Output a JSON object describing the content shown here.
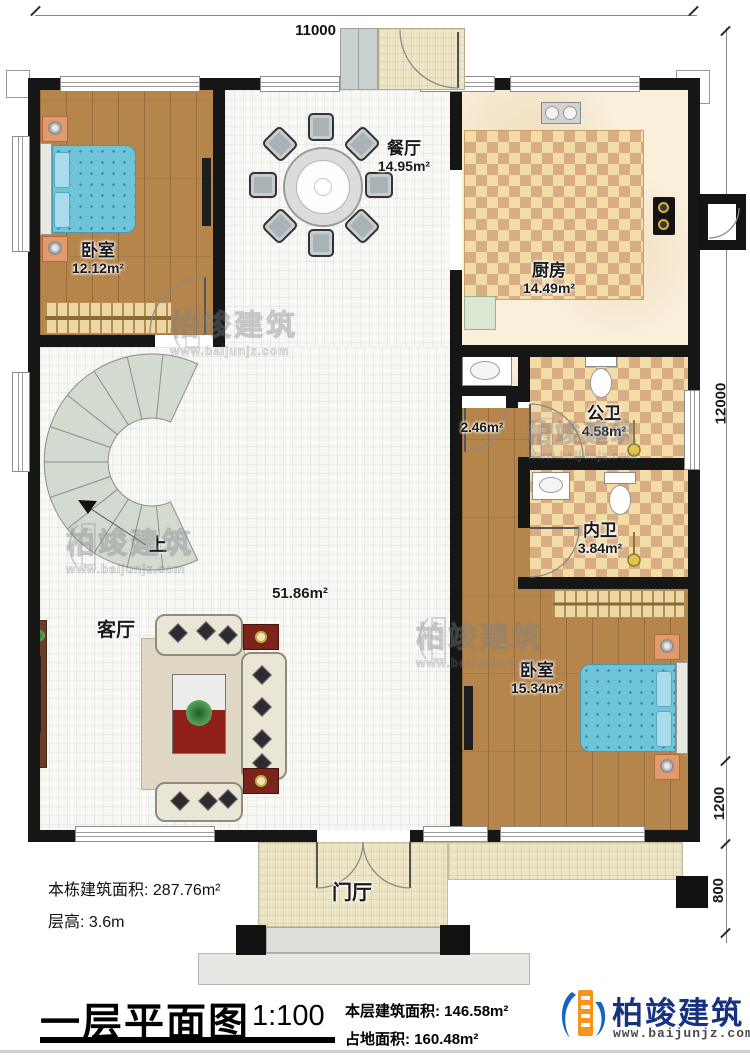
{
  "dimensions": {
    "top_width": "11000",
    "right_height": "12000",
    "right_porch": "1200",
    "right_step": "800"
  },
  "rooms": {
    "bedroom_left": {
      "label": "卧室",
      "area": "12.12m²"
    },
    "dining": {
      "label": "餐厅",
      "area": "14.95m²"
    },
    "kitchen": {
      "label": "厨房",
      "area": "14.49m²"
    },
    "hallway": {
      "area": "2.46m²"
    },
    "public_bath": {
      "label": "公卫",
      "area": "4.58m²"
    },
    "ensuite_bath": {
      "label": "内卫",
      "area": "3.84m²"
    },
    "bedroom_right": {
      "label": "卧室",
      "area": "15.34m²"
    },
    "living": {
      "label": "客厅",
      "area": "51.86m²"
    },
    "foyer": {
      "label": "门厅"
    },
    "stairs": {
      "label": "上"
    }
  },
  "notes": {
    "building_area": "本栋建筑面积: 287.76m²",
    "floor_height": "层高: 3.6m"
  },
  "footer": {
    "title": "一层平面图",
    "scale": "1:100",
    "floor_area": "本层建筑面积: 146.58m²",
    "land_area": "占地面积: 160.48m²"
  },
  "brand": {
    "name": "柏竣建筑",
    "website": "www.baijunjz.com"
  },
  "watermark": {
    "name": "柏竣建筑",
    "website": "www.baijunjz.com"
  },
  "colors": {
    "wall": "#161616",
    "wood_floor": "#b5854c",
    "checker_light": "#f4dca6",
    "checker_dark": "#d9ad84",
    "bed_blue": "#6fc4da",
    "brand_blue": "#17337f",
    "brand_orange": "#f7941d"
  }
}
